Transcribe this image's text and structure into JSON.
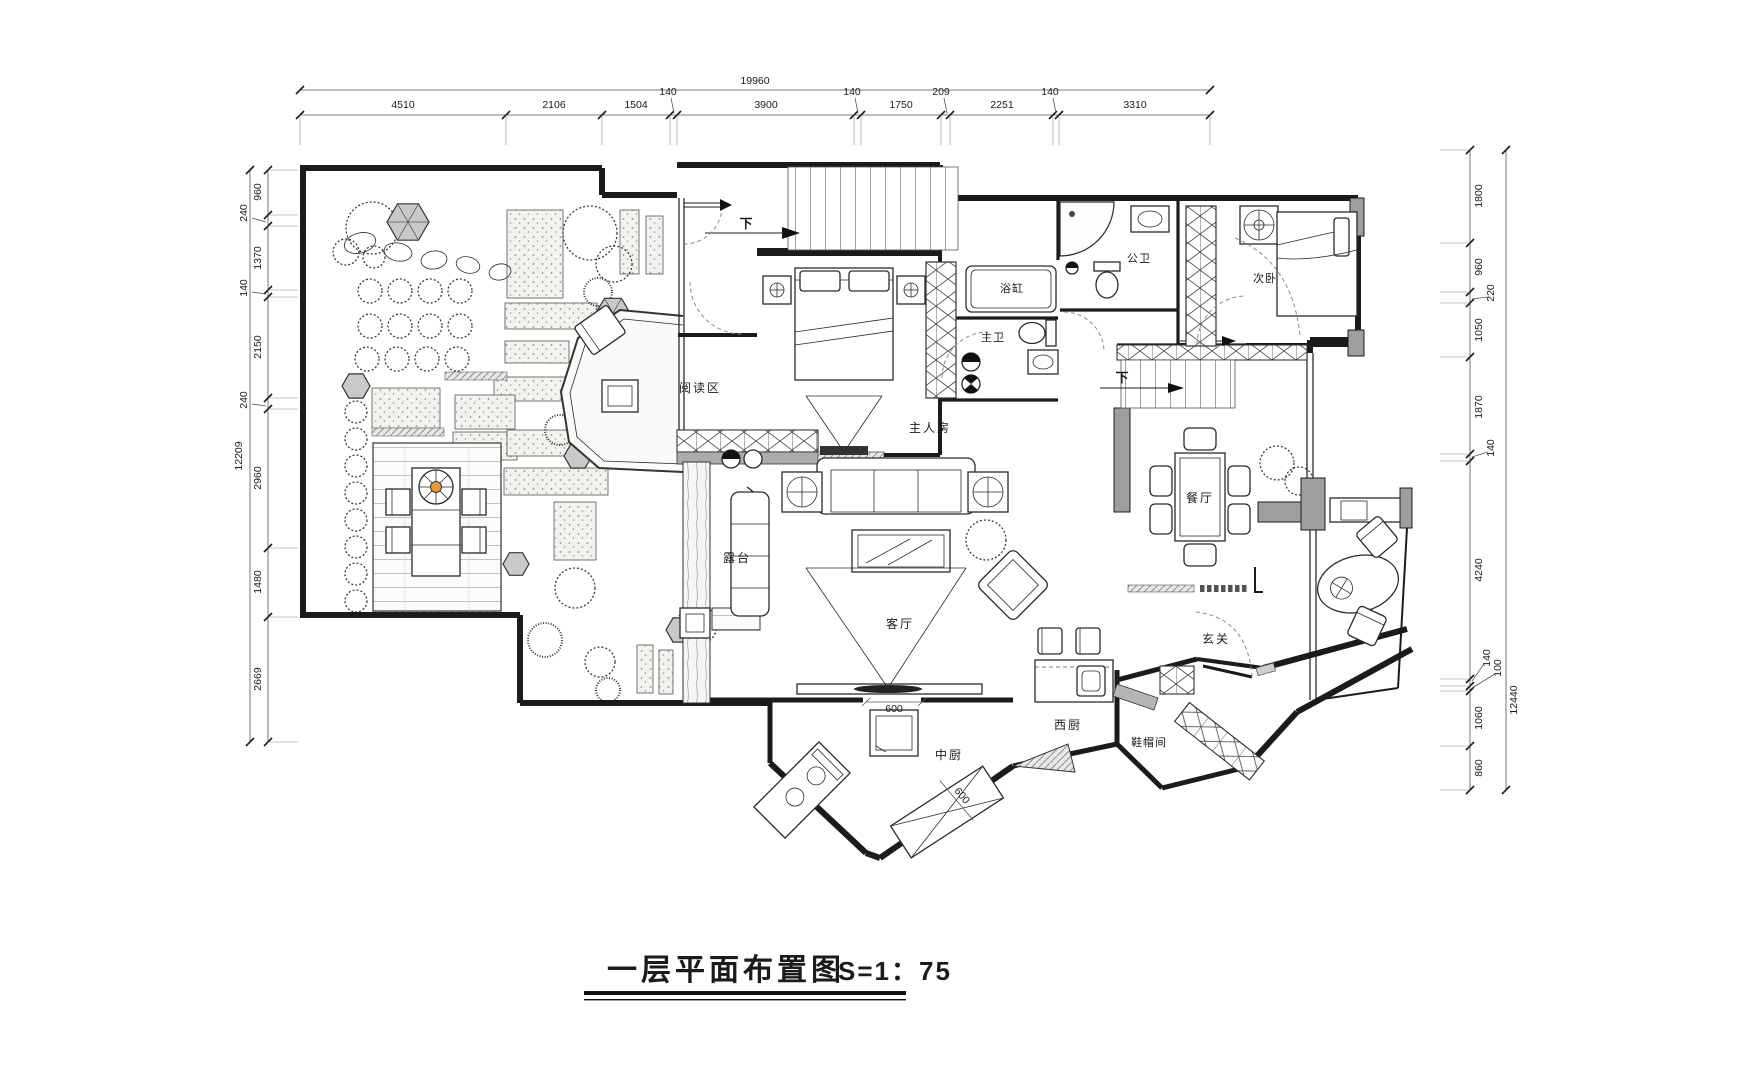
{
  "title": {
    "text": "一层平面布置图",
    "scale": "S=1：75"
  },
  "dimensions": {
    "top": {
      "total": "19960",
      "segments": [
        "4510",
        "2106",
        "1504",
        "140",
        "3900",
        "140",
        "1750",
        "209",
        "2251",
        "140",
        "3310"
      ]
    },
    "left": {
      "total": "12209",
      "segments": [
        "960",
        "240",
        "1370",
        "140",
        "2150",
        "240",
        "2960",
        "1480",
        "2669"
      ]
    },
    "right": {
      "total": "12440",
      "segments": [
        "1800",
        "960",
        "220",
        "1050",
        "1870",
        "140",
        "4240",
        "140",
        "100",
        "1060",
        "860"
      ]
    }
  },
  "rooms": {
    "reading_area": "阅读区",
    "master_bedroom": "主人房",
    "bathtub": "浴缸",
    "master_bath": "主卫",
    "guest_bath": "公卫",
    "second_bedroom": "次卧",
    "dining_room": "餐厅",
    "terrace": "露台",
    "living_room": "客厅",
    "entry": "玄关",
    "chinese_kitchen": "中厨",
    "western_kitchen": "西厨",
    "cloakroom": "鞋帽间"
  },
  "annotations": {
    "stair_down_1": "下",
    "stair_down_2": "下",
    "door_width_1": "600",
    "door_width_2": "600"
  },
  "colors": {
    "line": "#1b1b1b",
    "wall_fill": "#9e9e9e",
    "hex_fill": "#c9c9c9",
    "parasol_center": "#e8993c",
    "paper": "#ffffff"
  }
}
